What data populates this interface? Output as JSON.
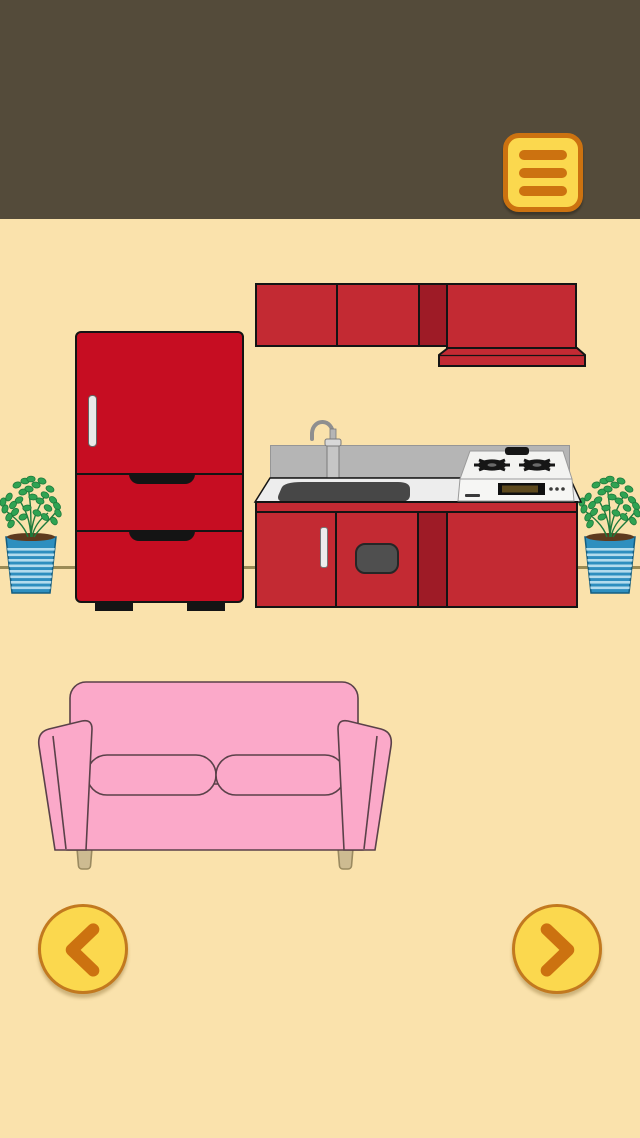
{
  "theme": {
    "header": "#544B3A",
    "wall": "#FAE2AC",
    "wall_line": "#9B8B55",
    "red_fridge": "#C60D22",
    "red_cab": "#C32A33",
    "red_dark": "#9E1B26",
    "outline": "#141414",
    "counter": "#EDEDED",
    "splash": "#B5B5B5",
    "sink": "#474747",
    "pink": "#FBA9C9",
    "pink_line": "#5A4149",
    "leg": "#CDBB91",
    "pot": "#2E8FBF",
    "pot_stripe": "#C2E5F2",
    "soil": "#5E3A1E",
    "leaf": "#2FA352",
    "leaf_dark": "#1E7A3C",
    "btn_yellow": "#FBD84E",
    "btn_orange": "#CC7210",
    "arrow_ring": "#C2791F",
    "metal": "#C6C6C6"
  },
  "header": {
    "menu_button_icon": "hamburger-icon"
  },
  "nav": {
    "prev_icon": "chevron-left-icon",
    "next_icon": "chevron-right-icon"
  },
  "scene": {
    "objects": [
      {
        "name": "refrigerator",
        "color_key": "red_fridge"
      },
      {
        "name": "upper-cabinet-doors",
        "color_key": "red_cab"
      },
      {
        "name": "range-hood",
        "color_key": "red_cab"
      },
      {
        "name": "backsplash",
        "color_key": "splash"
      },
      {
        "name": "countertop",
        "color_key": "counter"
      },
      {
        "name": "sink",
        "color_key": "sink"
      },
      {
        "name": "faucet",
        "color_key": "metal"
      },
      {
        "name": "gas-stove",
        "color_key": "counter"
      },
      {
        "name": "lower-cabinet-doors",
        "color_key": "red_cab"
      },
      {
        "name": "potted-plant-left",
        "color_key": "leaf"
      },
      {
        "name": "potted-plant-right",
        "color_key": "leaf"
      },
      {
        "name": "sofa",
        "color_key": "pink"
      }
    ]
  }
}
